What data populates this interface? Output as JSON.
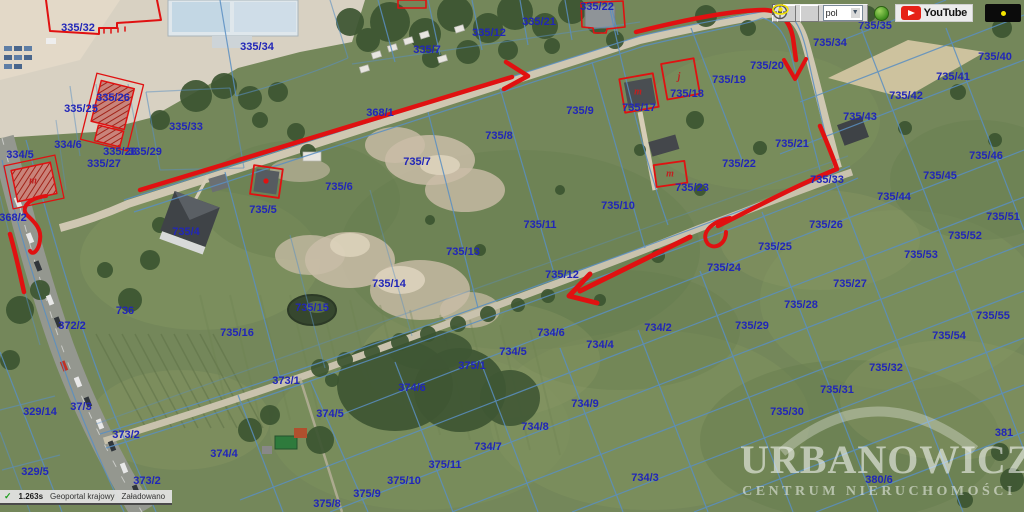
{
  "map": {
    "label_color": "#2126b8",
    "annotation_color": "#e01111",
    "parcels": [
      {
        "label": "335/32",
        "x": 78,
        "y": 28
      },
      {
        "label": "335/34",
        "x": 257,
        "y": 47
      },
      {
        "label": "335/12",
        "x": 489,
        "y": 33
      },
      {
        "label": "335/7",
        "x": 427,
        "y": 50
      },
      {
        "label": "335/21",
        "x": 539,
        "y": 22
      },
      {
        "label": "335/22",
        "x": 597,
        "y": 7
      },
      {
        "label": "335/33",
        "x": 186,
        "y": 127
      },
      {
        "label": "335/26",
        "x": 113,
        "y": 98
      },
      {
        "label": "335/25",
        "x": 81,
        "y": 109
      },
      {
        "label": "334/6",
        "x": 68,
        "y": 145
      },
      {
        "label": "334/5",
        "x": 20,
        "y": 155
      },
      {
        "label": "335/28",
        "x": 120,
        "y": 152
      },
      {
        "label": "335/29",
        "x": 145,
        "y": 152
      },
      {
        "label": "335/27",
        "x": 104,
        "y": 164
      },
      {
        "label": "368/1",
        "x": 380,
        "y": 113
      },
      {
        "label": "368/2",
        "x": 13,
        "y": 218
      },
      {
        "label": "735/9",
        "x": 580,
        "y": 111
      },
      {
        "label": "735/8",
        "x": 499,
        "y": 136
      },
      {
        "label": "735/7",
        "x": 417,
        "y": 162
      },
      {
        "label": "735/6",
        "x": 339,
        "y": 187
      },
      {
        "label": "735/5",
        "x": 263,
        "y": 210
      },
      {
        "label": "735/4",
        "x": 186,
        "y": 232
      },
      {
        "label": "735/17",
        "x": 639,
        "y": 108
      },
      {
        "label": "735/18",
        "x": 687,
        "y": 94
      },
      {
        "label": "735/19",
        "x": 729,
        "y": 80
      },
      {
        "label": "735/20",
        "x": 767,
        "y": 66
      },
      {
        "label": "735/35",
        "x": 875,
        "y": 26
      },
      {
        "label": "735/34",
        "x": 830,
        "y": 43
      },
      {
        "label": "735/40",
        "x": 995,
        "y": 57
      },
      {
        "label": "735/41",
        "x": 953,
        "y": 77
      },
      {
        "label": "735/42",
        "x": 906,
        "y": 96
      },
      {
        "label": "735/43",
        "x": 860,
        "y": 117
      },
      {
        "label": "735/21",
        "x": 792,
        "y": 144
      },
      {
        "label": "735/22",
        "x": 739,
        "y": 164
      },
      {
        "label": "735/46",
        "x": 986,
        "y": 156
      },
      {
        "label": "735/45",
        "x": 940,
        "y": 176
      },
      {
        "label": "735/44",
        "x": 894,
        "y": 197
      },
      {
        "label": "735/51",
        "x": 1003,
        "y": 217
      },
      {
        "label": "735/52",
        "x": 965,
        "y": 236
      },
      {
        "label": "735/33",
        "x": 827,
        "y": 180
      },
      {
        "label": "735/23",
        "x": 692,
        "y": 188
      },
      {
        "label": "735/26",
        "x": 826,
        "y": 225
      },
      {
        "label": "735/53",
        "x": 921,
        "y": 255
      },
      {
        "label": "735/25",
        "x": 775,
        "y": 247
      },
      {
        "label": "735/24",
        "x": 724,
        "y": 268
      },
      {
        "label": "735/27",
        "x": 850,
        "y": 284
      },
      {
        "label": "735/28",
        "x": 801,
        "y": 305
      },
      {
        "label": "735/29",
        "x": 752,
        "y": 326
      },
      {
        "label": "735/55",
        "x": 993,
        "y": 316
      },
      {
        "label": "735/54",
        "x": 949,
        "y": 336
      },
      {
        "label": "735/10",
        "x": 618,
        "y": 206
      },
      {
        "label": "735/11",
        "x": 540,
        "y": 225
      },
      {
        "label": "735/13",
        "x": 463,
        "y": 252
      },
      {
        "label": "735/12",
        "x": 562,
        "y": 275
      },
      {
        "label": "735/14",
        "x": 389,
        "y": 284
      },
      {
        "label": "735/15",
        "x": 312,
        "y": 308
      },
      {
        "label": "735/16",
        "x": 237,
        "y": 333
      },
      {
        "label": "736",
        "x": 125,
        "y": 311
      },
      {
        "label": "372/2",
        "x": 72,
        "y": 326
      },
      {
        "label": "734/2",
        "x": 658,
        "y": 328
      },
      {
        "label": "734/6",
        "x": 551,
        "y": 333
      },
      {
        "label": "734/4",
        "x": 600,
        "y": 345
      },
      {
        "label": "734/5",
        "x": 513,
        "y": 352
      },
      {
        "label": "375/1",
        "x": 472,
        "y": 366
      },
      {
        "label": "374/6",
        "x": 412,
        "y": 388
      },
      {
        "label": "734/9",
        "x": 585,
        "y": 404
      },
      {
        "label": "734/8",
        "x": 535,
        "y": 427
      },
      {
        "label": "734/7",
        "x": 488,
        "y": 447
      },
      {
        "label": "375/11",
        "x": 445,
        "y": 465
      },
      {
        "label": "375/10",
        "x": 404,
        "y": 481
      },
      {
        "label": "375/9",
        "x": 367,
        "y": 494
      },
      {
        "label": "734/3",
        "x": 645,
        "y": 478
      },
      {
        "label": "373/1",
        "x": 286,
        "y": 381
      },
      {
        "label": "373/2",
        "x": 126,
        "y": 435
      },
      {
        "label": "373/2",
        "x": 147,
        "y": 481
      },
      {
        "label": "37/3",
        "x": 81,
        "y": 407
      },
      {
        "label": "329/14",
        "x": 40,
        "y": 412
      },
      {
        "label": "329/5",
        "x": 35,
        "y": 472
      },
      {
        "label": "374/5",
        "x": 330,
        "y": 414
      },
      {
        "label": "374/4",
        "x": 224,
        "y": 454
      },
      {
        "label": "375/8",
        "x": 327,
        "y": 504
      },
      {
        "label": "735/32",
        "x": 886,
        "y": 368
      },
      {
        "label": "735/31",
        "x": 837,
        "y": 390
      },
      {
        "label": "735/30",
        "x": 787,
        "y": 412
      },
      {
        "label": "380/6",
        "x": 879,
        "y": 480
      },
      {
        "label": "381",
        "x": 1004,
        "y": 433
      }
    ],
    "building_letters": [
      {
        "ch": "m",
        "x": 33,
        "y": 181
      },
      {
        "ch": "m",
        "x": 638,
        "y": 92
      },
      {
        "ch": "j",
        "x": 679,
        "y": 77
      },
      {
        "ch": "m",
        "x": 670,
        "y": 174
      }
    ]
  },
  "toolbar": {
    "language_value": "pol",
    "youtube_label": "YouTube"
  },
  "statusbar": {
    "check": "✓",
    "time": "1.263s",
    "source": "Geoportal krajowy",
    "state": "Załadowano"
  },
  "watermark": {
    "title": "URBANOWICZ",
    "subtitle": "CENTRUM NIERUCHOMOŚCI"
  }
}
